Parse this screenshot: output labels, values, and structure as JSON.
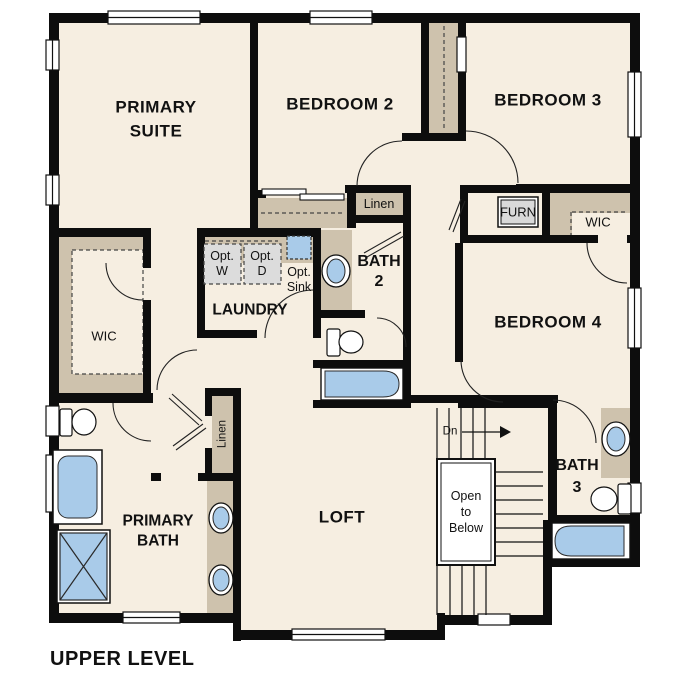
{
  "title": "UPPER LEVEL",
  "colors": {
    "floor": "#f6eee1",
    "wall": "#0d0d0d",
    "closet_tan": "#cec2ad",
    "fixture_blue": "#a9cbe9",
    "appliance_gray": "#dcdcdc"
  },
  "rooms": {
    "primary_suite": {
      "line1": "PRIMARY",
      "line2": "SUITE"
    },
    "bedroom2": "BEDROOM 2",
    "bedroom3": "BEDROOM 3",
    "bedroom4": "BEDROOM 4",
    "loft": "LOFT",
    "laundry": "LAUNDRY",
    "primary_bath": {
      "line1": "PRIMARY",
      "line2": "BATH"
    },
    "bath2": {
      "line1": "BATH",
      "line2": "2"
    },
    "bath3": {
      "line1": "BATH",
      "line2": "3"
    },
    "wic_left": "WIC",
    "wic_right": "WIC"
  },
  "closets": {
    "linen_hall": "Linen",
    "linen_primary": "Linen",
    "furnace": "FURN"
  },
  "options": {
    "washer": {
      "line1": "Opt.",
      "line2": "W"
    },
    "dryer": {
      "line1": "Opt.",
      "line2": "D"
    },
    "sink": {
      "line1": "Opt.",
      "line2": "Sink"
    }
  },
  "stairs": {
    "down": "Dn",
    "open_to_below": {
      "line1": "Open",
      "line2": "to",
      "line3": "Below"
    }
  }
}
